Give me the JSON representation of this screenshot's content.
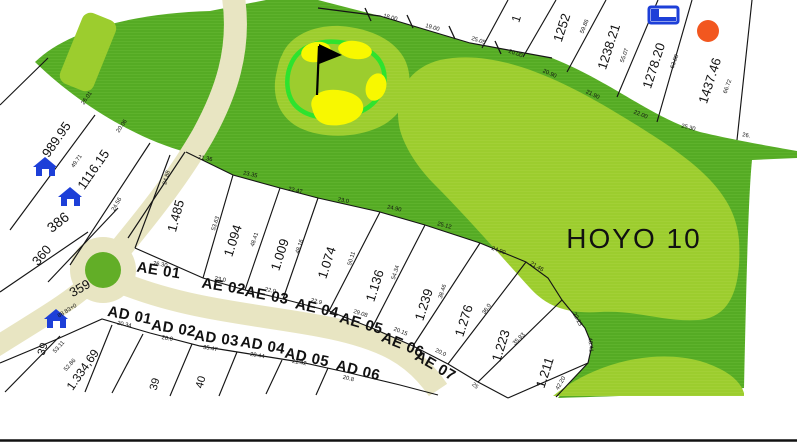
{
  "map": {
    "hole_label": "HOYO 10",
    "colors": {
      "background": "#ffffff",
      "rough_green": "#55ab24",
      "rough_stripe": "#6abb36",
      "fairway_green": "#9ccd2e",
      "fairway_stripe": "#a8d63e",
      "green_ring": "#2ee32e",
      "bunker_yellow": "#f8f800",
      "road_beige": "#e8e5c2",
      "roundabout_green": "#62ae27",
      "house_blue": "#1d3fd8",
      "marker_orange": "#f2571f",
      "line_black": "#151515",
      "text_black": "#111111"
    },
    "parcel_labels": [
      {
        "text": "989.95",
        "x": 60,
        "y": 142,
        "rot": -55,
        "size": 13
      },
      {
        "text": "1116.15",
        "x": 97,
        "y": 172,
        "rot": -55,
        "size": 13
      },
      {
        "text": "386",
        "x": 61,
        "y": 226,
        "rot": -38,
        "size": 14
      },
      {
        "text": "360",
        "x": 45,
        "y": 258,
        "rot": -50,
        "size": 13
      },
      {
        "text": "359",
        "x": 82,
        "y": 292,
        "rot": -30,
        "size": 13
      },
      {
        "text": "1.334,69",
        "x": 86,
        "y": 372,
        "rot": -55,
        "size": 12
      },
      {
        "text": "39",
        "x": 46,
        "y": 350,
        "rot": -72,
        "size": 11
      },
      {
        "text": "39",
        "x": 158,
        "y": 385,
        "rot": -75,
        "size": 11
      },
      {
        "text": "40",
        "x": 204,
        "y": 383,
        "rot": -75,
        "size": 11
      },
      {
        "text": "1.485",
        "x": 180,
        "y": 217,
        "rot": -75,
        "size": 13
      },
      {
        "text": "1.094",
        "x": 237,
        "y": 242,
        "rot": -72,
        "size": 13
      },
      {
        "text": "1.009",
        "x": 284,
        "y": 256,
        "rot": -72,
        "size": 13
      },
      {
        "text": "1.074",
        "x": 331,
        "y": 264,
        "rot": -72,
        "size": 13
      },
      {
        "text": "1.136",
        "x": 379,
        "y": 287,
        "rot": -72,
        "size": 13
      },
      {
        "text": "1.239",
        "x": 428,
        "y": 306,
        "rot": -72,
        "size": 13
      },
      {
        "text": "1.276",
        "x": 468,
        "y": 322,
        "rot": -72,
        "size": 13
      },
      {
        "text": "1.223",
        "x": 505,
        "y": 347,
        "rot": -72,
        "size": 13
      },
      {
        "text": "1.211",
        "x": 549,
        "y": 374,
        "rot": -72,
        "size": 13
      },
      {
        "text": "1",
        "x": 520,
        "y": 20,
        "rot": -72,
        "size": 12
      },
      {
        "text": "1252",
        "x": 566,
        "y": 29,
        "rot": -72,
        "size": 13
      },
      {
        "text": "1238.21",
        "x": 613,
        "y": 48,
        "rot": -72,
        "size": 13
      },
      {
        "text": "1278.20",
        "x": 658,
        "y": 67,
        "rot": -72,
        "size": 13
      },
      {
        "text": "1437.46",
        "x": 714,
        "y": 82,
        "rot": -72,
        "size": 13
      }
    ],
    "street_labels": [
      {
        "text": "AE 01",
        "x": 158,
        "y": 275,
        "rot": 9
      },
      {
        "text": "AE 02",
        "x": 223,
        "y": 291,
        "rot": 9
      },
      {
        "text": "AE 03",
        "x": 266,
        "y": 300,
        "rot": 11
      },
      {
        "text": "AE 04",
        "x": 316,
        "y": 313,
        "rot": 13
      },
      {
        "text": "AE 05",
        "x": 360,
        "y": 328,
        "rot": 16
      },
      {
        "text": "AE 06",
        "x": 401,
        "y": 349,
        "rot": 22
      },
      {
        "text": "AE 07",
        "x": 433,
        "y": 370,
        "rot": 30
      },
      {
        "text": "AD 01",
        "x": 129,
        "y": 320,
        "rot": 11
      },
      {
        "text": "AD 02",
        "x": 173,
        "y": 333,
        "rot": 9
      },
      {
        "text": "AD 03",
        "x": 216,
        "y": 343,
        "rot": 8
      },
      {
        "text": "AD 04",
        "x": 262,
        "y": 350,
        "rot": 10
      },
      {
        "text": "AD 05",
        "x": 306,
        "y": 362,
        "rot": 12
      },
      {
        "text": "AD 06",
        "x": 357,
        "y": 375,
        "rot": 14
      }
    ],
    "measurement_labels": [
      {
        "text": "18.00",
        "x": 390,
        "y": 19,
        "rot": 14
      },
      {
        "text": "19.00",
        "x": 432,
        "y": 29,
        "rot": 16
      },
      {
        "text": "25.05",
        "x": 478,
        "y": 42,
        "rot": 18
      },
      {
        "text": "20.00",
        "x": 515,
        "y": 55,
        "rot": 20
      },
      {
        "text": "20.90",
        "x": 549,
        "y": 75,
        "rot": 24
      },
      {
        "text": "21.90",
        "x": 592,
        "y": 96,
        "rot": 26
      },
      {
        "text": "22.00",
        "x": 640,
        "y": 116,
        "rot": 22
      },
      {
        "text": "25.30",
        "x": 688,
        "y": 129,
        "rot": 14
      },
      {
        "text": "26.",
        "x": 746,
        "y": 137,
        "rot": 10
      },
      {
        "text": "59.86",
        "x": 586,
        "y": 27,
        "rot": -68
      },
      {
        "text": "55.07",
        "x": 626,
        "y": 56,
        "rot": -70
      },
      {
        "text": "63.88",
        "x": 676,
        "y": 62,
        "rot": -70
      },
      {
        "text": "66.72",
        "x": 729,
        "y": 87,
        "rot": -70
      },
      {
        "text": "26.01",
        "x": 88,
        "y": 99,
        "rot": -55
      },
      {
        "text": "20.06",
        "x": 123,
        "y": 127,
        "rot": -55
      },
      {
        "text": "49.71",
        "x": 78,
        "y": 162,
        "rot": -55
      },
      {
        "text": "24.56",
        "x": 118,
        "y": 205,
        "rot": -60
      },
      {
        "text": "21.36",
        "x": 205,
        "y": 160,
        "rot": 10
      },
      {
        "text": "23.35",
        "x": 250,
        "y": 176,
        "rot": 12
      },
      {
        "text": "22.47",
        "x": 295,
        "y": 192,
        "rot": 13
      },
      {
        "text": "23.0",
        "x": 343,
        "y": 202,
        "rot": 12
      },
      {
        "text": "24.90",
        "x": 394,
        "y": 210,
        "rot": 12
      },
      {
        "text": "25.12",
        "x": 444,
        "y": 227,
        "rot": 15
      },
      {
        "text": "24.90",
        "x": 498,
        "y": 252,
        "rot": 20
      },
      {
        "text": "21.46",
        "x": 536,
        "y": 268,
        "rot": 30
      },
      {
        "text": "22.23",
        "x": 576,
        "y": 320,
        "rot": 62
      },
      {
        "text": "40.41",
        "x": 589,
        "y": 345,
        "rot": 84
      },
      {
        "text": "42.20",
        "x": 562,
        "y": 384,
        "rot": -60
      },
      {
        "text": "24.88",
        "x": 168,
        "y": 178,
        "rot": -75
      },
      {
        "text": "53.63",
        "x": 217,
        "y": 224,
        "rot": -72
      },
      {
        "text": "48.41",
        "x": 256,
        "y": 240,
        "rot": -72
      },
      {
        "text": "48.16",
        "x": 301,
        "y": 247,
        "rot": -72
      },
      {
        "text": "50.11",
        "x": 353,
        "y": 259,
        "rot": -72
      },
      {
        "text": "54.34",
        "x": 397,
        "y": 273,
        "rot": -72
      },
      {
        "text": "38.46",
        "x": 444,
        "y": 292,
        "rot": -72
      },
      {
        "text": "36.0",
        "x": 488,
        "y": 310,
        "rot": -55
      },
      {
        "text": "35.93",
        "x": 520,
        "y": 340,
        "rot": -45
      },
      {
        "text": "53.11",
        "x": 60,
        "y": 348,
        "rot": -48
      },
      {
        "text": "52.86",
        "x": 71,
        "y": 366,
        "rot": -48
      },
      {
        "text": "88 83+0",
        "x": 68,
        "y": 312,
        "rot": -32
      },
      {
        "text": "20.34",
        "x": 124,
        "y": 326,
        "rot": 12
      },
      {
        "text": "20.0",
        "x": 167,
        "y": 340,
        "rot": 10
      },
      {
        "text": "35.47",
        "x": 210,
        "y": 350,
        "rot": 10
      },
      {
        "text": "20.44",
        "x": 257,
        "y": 357,
        "rot": 10
      },
      {
        "text": "21.42",
        "x": 299,
        "y": 364,
        "rot": 10
      },
      {
        "text": "20.8",
        "x": 348,
        "y": 380,
        "rot": 14
      },
      {
        "text": "26.30",
        "x": 160,
        "y": 266,
        "rot": 10
      },
      {
        "text": "23.0",
        "x": 220,
        "y": 281,
        "rot": 10
      },
      {
        "text": "22.0",
        "x": 270,
        "y": 292,
        "rot": 12
      },
      {
        "text": "22.9",
        "x": 316,
        "y": 303,
        "rot": 14
      },
      {
        "text": "29.08",
        "x": 360,
        "y": 315,
        "rot": 18
      },
      {
        "text": "20.15",
        "x": 400,
        "y": 333,
        "rot": 22
      },
      {
        "text": "20.0",
        "x": 440,
        "y": 354,
        "rot": 26
      },
      {
        "text": "25",
        "x": 474,
        "y": 387,
        "rot": 40
      }
    ],
    "house_positions": [
      {
        "x": 33,
        "y": 156
      },
      {
        "x": 58,
        "y": 186
      },
      {
        "x": 44,
        "y": 308
      }
    ],
    "building_marker": {
      "x": 648,
      "y": 6
    },
    "orange_marker": {
      "x": 708,
      "y": 31,
      "r": 11
    }
  }
}
